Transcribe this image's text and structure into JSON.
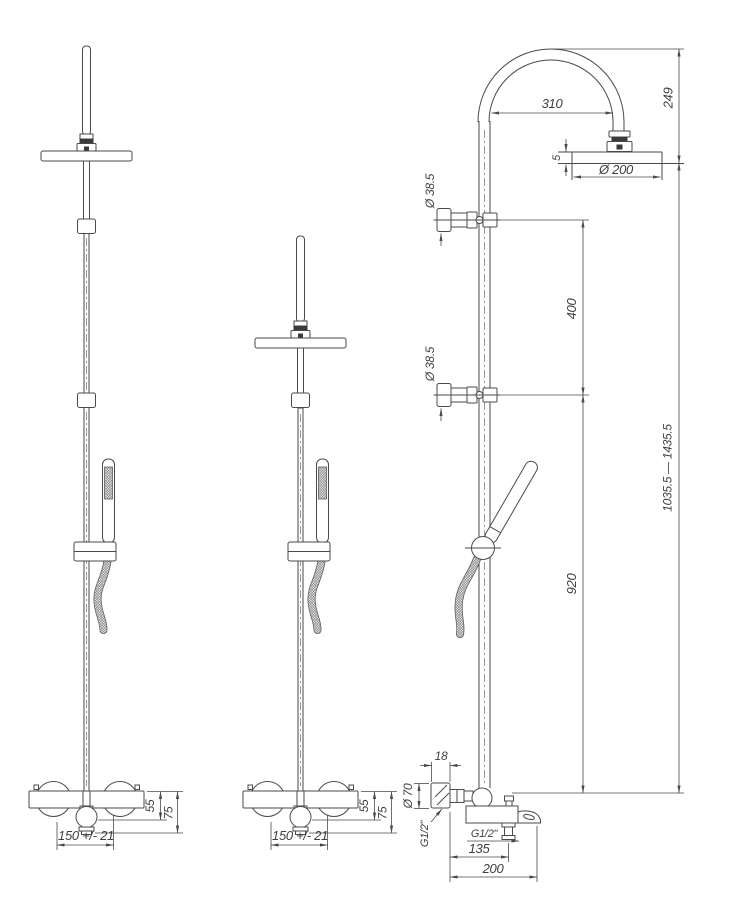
{
  "drawing": {
    "line_color": "#4a4a4a",
    "views": {
      "front_left": {
        "dims": {
          "center_distance": "150 +/- 21",
          "spout_height": "55",
          "body_height": "75"
        }
      },
      "front_middle": {
        "dims": {
          "center_distance": "150 +/- 21",
          "spout_height": "55",
          "body_height": "75"
        }
      },
      "side": {
        "dims": {
          "arm_reach": "310",
          "arm_height": "249",
          "head_diameter": "Ø 200",
          "head_rim": "5",
          "upper_bracket_diameter": "Ø 38.5",
          "lower_bracket_diameter": "Ø 38.5",
          "bracket_spacing": "400",
          "rail_length": "920",
          "overall_height_range": "1035.5 — 1435.5",
          "wall_plate_depth": "18",
          "wall_plate_diameter": "Ø 70",
          "inlet_thread": "G1/2\"",
          "outlet_thread": "G1/2\"",
          "outlet_reach": "135",
          "spout_reach": "200"
        }
      }
    }
  }
}
